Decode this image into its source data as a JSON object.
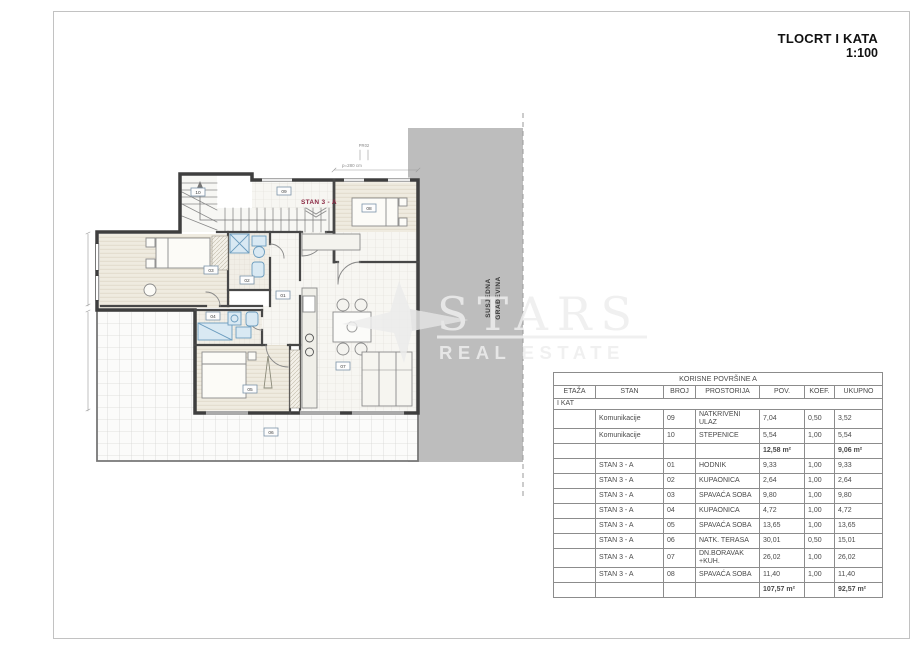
{
  "page": {
    "title": "TLOCRT I KATA",
    "scale": "1:100"
  },
  "watermark": {
    "brand": "STARS",
    "tagline": "REAL ESTATE"
  },
  "plan": {
    "apartment_label": "STAN 3 - A",
    "neighbor_line1": "SUSJEDNA",
    "neighbor_line2": "GRAĐEVINA",
    "parapet_note": "p=280 cm",
    "window_mark": "PR02",
    "room_tags": [
      "10",
      "09",
      "08",
      "03",
      "02",
      "01",
      "04",
      "05",
      "07",
      "06"
    ]
  },
  "table": {
    "title": "KORISNE POVRŠINE A",
    "columns": [
      "ETAŽA",
      "STAN",
      "BROJ",
      "PROSTORIJA",
      "POV.",
      "KOEF.",
      "UKUPNO"
    ],
    "section": "I KAT",
    "rows": [
      {
        "stan": "Komunikacije",
        "broj": "09",
        "prostorija": "NATKRIVENI ULAZ",
        "pov": "7,04",
        "koef": "0,50",
        "ukupno": "3,52"
      },
      {
        "stan": "Komunikacije",
        "broj": "10",
        "prostorija": "STEPENICE",
        "pov": "5,54",
        "koef": "1,00",
        "ukupno": "5,54"
      },
      {
        "type": "sum",
        "pov": "12,58 m²",
        "ukupno": "9,06 m²"
      },
      {
        "stan": "STAN 3 - A",
        "broj": "01",
        "prostorija": "HODNIK",
        "pov": "9,33",
        "koef": "1,00",
        "ukupno": "9,33"
      },
      {
        "stan": "STAN 3 - A",
        "broj": "02",
        "prostorija": "KUPAONICA",
        "pov": "2,64",
        "koef": "1,00",
        "ukupno": "2,64"
      },
      {
        "stan": "STAN 3 - A",
        "broj": "03",
        "prostorija": "SPAVAĆA SOBA",
        "pov": "9,80",
        "koef": "1,00",
        "ukupno": "9,80"
      },
      {
        "stan": "STAN 3 - A",
        "broj": "04",
        "prostorija": "KUPAONICA",
        "pov": "4,72",
        "koef": "1,00",
        "ukupno": "4,72"
      },
      {
        "stan": "STAN 3 - A",
        "broj": "05",
        "prostorija": "SPAVAĆA SOBA",
        "pov": "13,65",
        "koef": "1,00",
        "ukupno": "13,65"
      },
      {
        "stan": "STAN 3 - A",
        "broj": "06",
        "prostorija": "NATK. TERASA",
        "pov": "30,01",
        "koef": "0,50",
        "ukupno": "15,01"
      },
      {
        "stan": "STAN 3 - A",
        "broj": "07",
        "prostorija": "DN.BORAVAK +KUH.",
        "pov": "26,02",
        "koef": "1,00",
        "ukupno": "26,02"
      },
      {
        "stan": "STAN 3 - A",
        "broj": "08",
        "prostorija": "SPAVAĆA SOBA",
        "pov": "11,40",
        "koef": "1,00",
        "ukupno": "11,40"
      },
      {
        "type": "sum",
        "pov": "107,57 m²",
        "ukupno": "92,57 m²"
      }
    ]
  },
  "colors": {
    "neighbor_band": "#bdbdbd",
    "apartment_accent": "#8b2742",
    "fixture_blue": "#6b9cbe",
    "watermark": "#ededed"
  }
}
